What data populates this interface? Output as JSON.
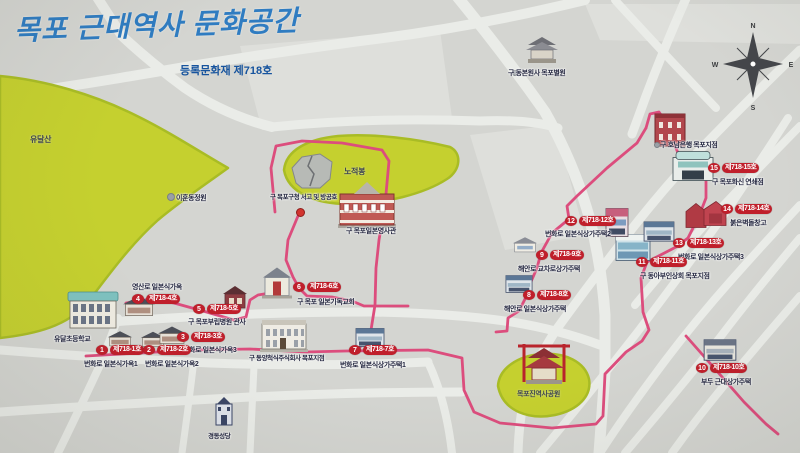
{
  "map": {
    "title": "목포 근대역사 문화공간",
    "subtitle": "등록문화재 제718호",
    "colors": {
      "background": "#d4d5d1",
      "road": "#eaece8",
      "green_area": "#c5d02f",
      "route_pink": "#dc4d7d",
      "badge_red": "#c01f2b",
      "title_blue": "#2f7cc1"
    }
  },
  "sites": [
    {
      "num": "1",
      "badge": "제718-1호",
      "name": "번화로 일본식가옥1"
    },
    {
      "num": "2",
      "badge": "제718-2호",
      "name": "번화로 일본식가옥2"
    },
    {
      "num": "3",
      "badge": "제718-3호",
      "name": "번화로 일본식가옥3"
    },
    {
      "num": "4",
      "badge": "제718-4호",
      "name": "영산로 일본식가옥"
    },
    {
      "num": "5",
      "badge": "제718-5호",
      "name": "구 목포부립병원 관사"
    },
    {
      "num": "6",
      "badge": "제718-6호",
      "name": "구 목포 일본기독교회"
    },
    {
      "num": "7",
      "badge": "제718-7호",
      "name": "번화로 일본식상가주택1"
    },
    {
      "num": "8",
      "badge": "제718-8호",
      "name": "해안로 일본식상가주택"
    },
    {
      "num": "9",
      "badge": "제718-9호",
      "name": "해안로 교차로상가주택"
    },
    {
      "num": "10",
      "badge": "제718-10호",
      "name": "부두 근대상가주택"
    },
    {
      "num": "11",
      "badge": "제718-11호",
      "name": "구 동아부인상회 목포지점"
    },
    {
      "num": "12",
      "badge": "제718-12호",
      "name": "번화로 일본식상가주택2"
    },
    {
      "num": "13",
      "badge": "제718-13호",
      "name": "번화로 일본식상가주택3"
    },
    {
      "num": "14",
      "badge": "제718-14호",
      "name": "붉은벽돌창고"
    },
    {
      "num": "15",
      "badge": "제718-15호",
      "name": "구 목포화신 연쇄점"
    }
  ],
  "landmarks": [
    {
      "name": "구 동본원사 목포별원"
    },
    {
      "name": "구 호남은행 목포지점"
    },
    {
      "name": "구 목포구청 서고 및 방공호"
    },
    {
      "name": "구 목포일본영사관"
    },
    {
      "name": "구 동양척식주식회사 목포지점"
    },
    {
      "name": "유달초등학교"
    },
    {
      "name": "경동성당"
    },
    {
      "name": "이훈동정원"
    }
  ],
  "areas": [
    {
      "name": "유달산"
    },
    {
      "name": "노적봉"
    },
    {
      "name": "목포진역사공원"
    }
  ],
  "compass": {
    "n": "N",
    "e": "E",
    "s": "S",
    "w": "W"
  }
}
